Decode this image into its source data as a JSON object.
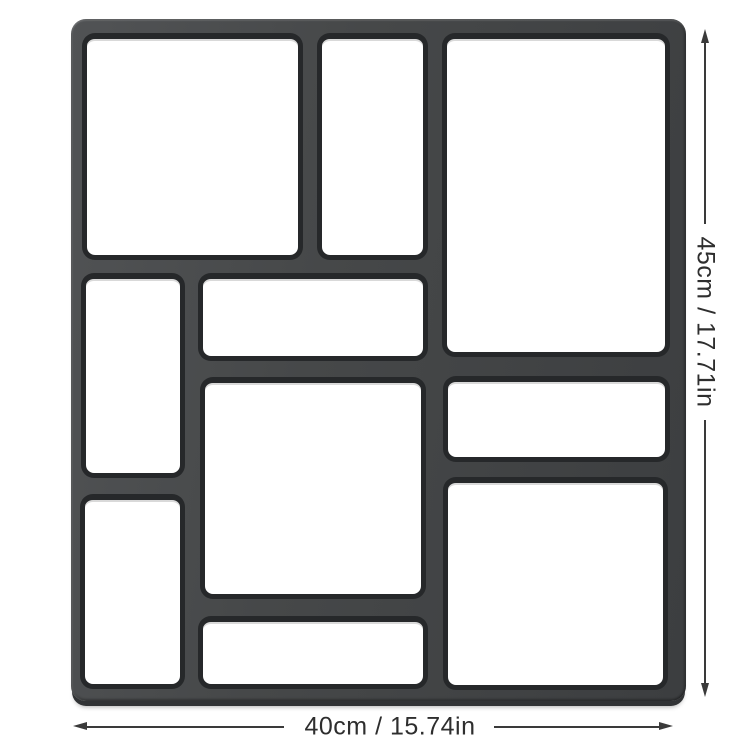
{
  "diagram": {
    "kind": "product-dimension-diagram",
    "dimensions": {
      "height_label": "45cm / 17.71in",
      "width_label": "40cm / 15.74in"
    },
    "colors": {
      "background": "#ffffff",
      "mold": "#464849",
      "mold_base": "#313335",
      "cavity": "#ffffff",
      "cavity_border": "#26282a",
      "line": "#3a3a3a",
      "text": "#2e2e2e"
    },
    "mold": {
      "x": 71,
      "y": 19,
      "width": 615,
      "height": 682,
      "cavities": [
        {
          "id": "top-left",
          "x": 11,
          "y": 14,
          "w": 221,
          "h": 227
        },
        {
          "id": "top-middle",
          "x": 246,
          "y": 14,
          "w": 111,
          "h": 227
        },
        {
          "id": "top-right",
          "x": 371,
          "y": 14,
          "w": 228,
          "h": 324
        },
        {
          "id": "mid-left",
          "x": 10,
          "y": 254,
          "w": 104,
          "h": 205
        },
        {
          "id": "mid-wide",
          "x": 127,
          "y": 254,
          "w": 230,
          "h": 88
        },
        {
          "id": "center",
          "x": 129,
          "y": 358,
          "w": 226,
          "h": 222
        },
        {
          "id": "right-mid",
          "x": 372,
          "y": 357,
          "w": 227,
          "h": 86
        },
        {
          "id": "right-bottom",
          "x": 372,
          "y": 458,
          "w": 225,
          "h": 213
        },
        {
          "id": "bottom-left",
          "x": 9,
          "y": 475,
          "w": 105,
          "h": 195
        },
        {
          "id": "bottom-wide",
          "x": 127,
          "y": 597,
          "w": 230,
          "h": 73
        }
      ]
    },
    "height_dim": {
      "line_x": 704,
      "tip_top_y": 29,
      "seg1_y1": 42,
      "seg1_y2": 224,
      "seg2_y1": 420,
      "seg2_y2": 683,
      "tip_bottom_y": 683
    },
    "width_dim": {
      "line_y": 726,
      "tip_left_x": 73,
      "seg1_x1": 86,
      "seg1_x2": 284,
      "seg2_x1": 494,
      "seg2_x2": 659,
      "tip_right_x": 659
    }
  }
}
